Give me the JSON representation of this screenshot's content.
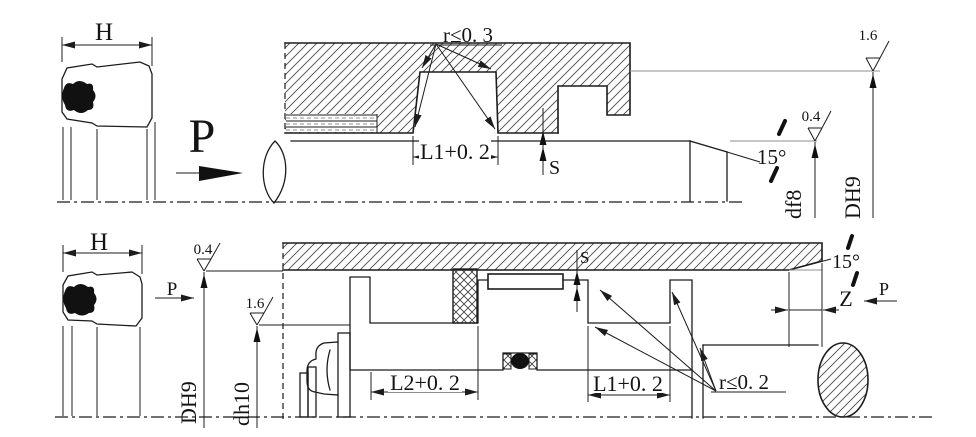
{
  "figure_top": {
    "seal_width_label": "H",
    "pressure_label": "P",
    "groove_radius_note": "r≤0. 3",
    "groove_length_dim": "L1+0. 2",
    "clearance_label": "S",
    "chamfer_angle": "15°",
    "rod_surface_finish": "0.4",
    "bore_surface_finish": "1.6",
    "rod_diameter_code": "df8",
    "bore_diameter_code": "DH9"
  },
  "figure_bottom": {
    "seal_width_label": "H",
    "pressure_left_label": "P",
    "pressure_right_label": "P",
    "bore_surface_finish": "0.4",
    "groove_surface_finish": "1.6",
    "bore_diameter_code": "DH9",
    "groove_diameter_code": "dh10",
    "groove2_length_dim": "L2+0. 2",
    "groove1_length_dim": "L1+0. 2",
    "groove_radius_note": "r≤0. 2",
    "clearance_label": "S",
    "chamfer_angle": "15°",
    "chamfer_length_label": "Z"
  },
  "colors": {
    "line": "#1c1c1c",
    "reference_line": "#8f8f8f",
    "hatch": "#4a4a4a",
    "background": "#ffffff"
  }
}
